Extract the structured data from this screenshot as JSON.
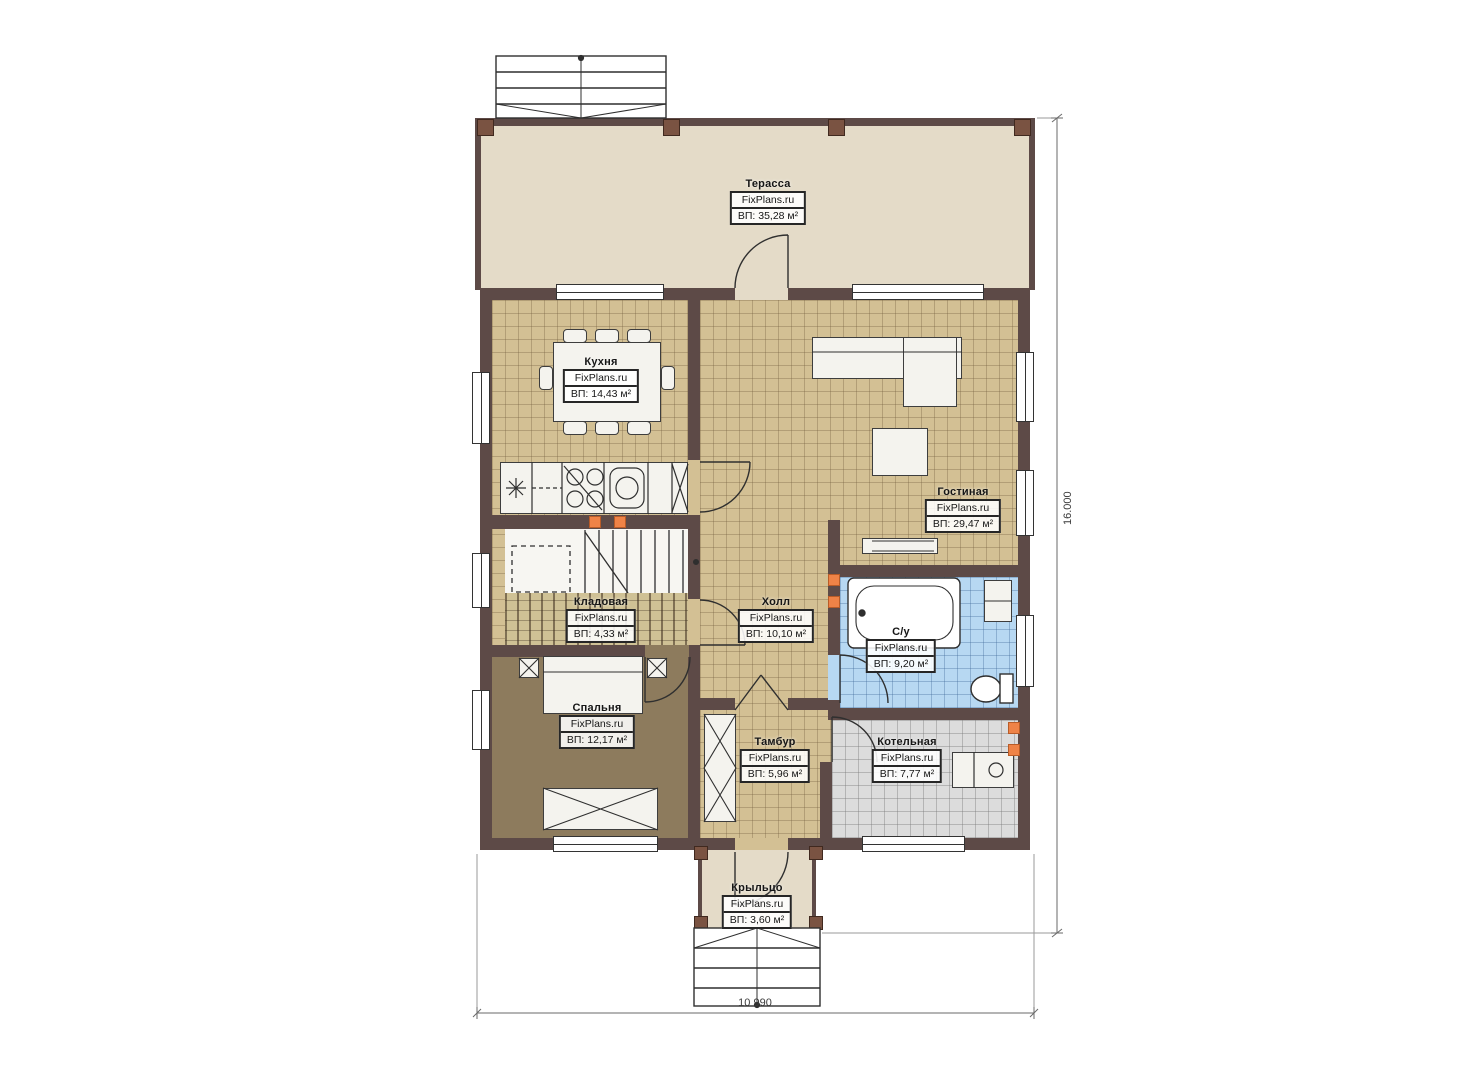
{
  "plan": {
    "watermark": "FixPlans.ru",
    "rooms": [
      {
        "id": "terrace",
        "name": "Терасса",
        "area": "ВП: 35,28 м²"
      },
      {
        "id": "kitchen",
        "name": "Кухня",
        "area": "ВП: 14,43 м²"
      },
      {
        "id": "living",
        "name": "Гостиная",
        "area": "ВП: 29,47 м²"
      },
      {
        "id": "hall",
        "name": "Холл",
        "area": "ВП: 10,10 м²"
      },
      {
        "id": "storage",
        "name": "Кладовая",
        "area": "ВП: 4,33 м²"
      },
      {
        "id": "bedroom",
        "name": "Спальня",
        "area": "ВП: 12,17 м²"
      },
      {
        "id": "bathroom",
        "name": "С/у",
        "area": "ВП: 9,20 м²"
      },
      {
        "id": "tambour",
        "name": "Тамбур",
        "area": "ВП: 5,96 м²"
      },
      {
        "id": "boiler",
        "name": "Котельная",
        "area": "ВП: 7,77 м²"
      },
      {
        "id": "porch",
        "name": "Крыльцо",
        "area": "ВП: 3,60 м²"
      }
    ],
    "dimensions": {
      "right": "16.000",
      "bottom": "10 990"
    },
    "colors": {
      "wall": "#5d4a47",
      "floor_main": "#d3c094",
      "floor_bathroom": "#b7d8f2",
      "floor_boiler": "#dcdcdc",
      "floor_bedroom": "#8d7b5d",
      "floor_terrace": "#e4dbc8",
      "accent_vent": "#ef8347"
    }
  }
}
